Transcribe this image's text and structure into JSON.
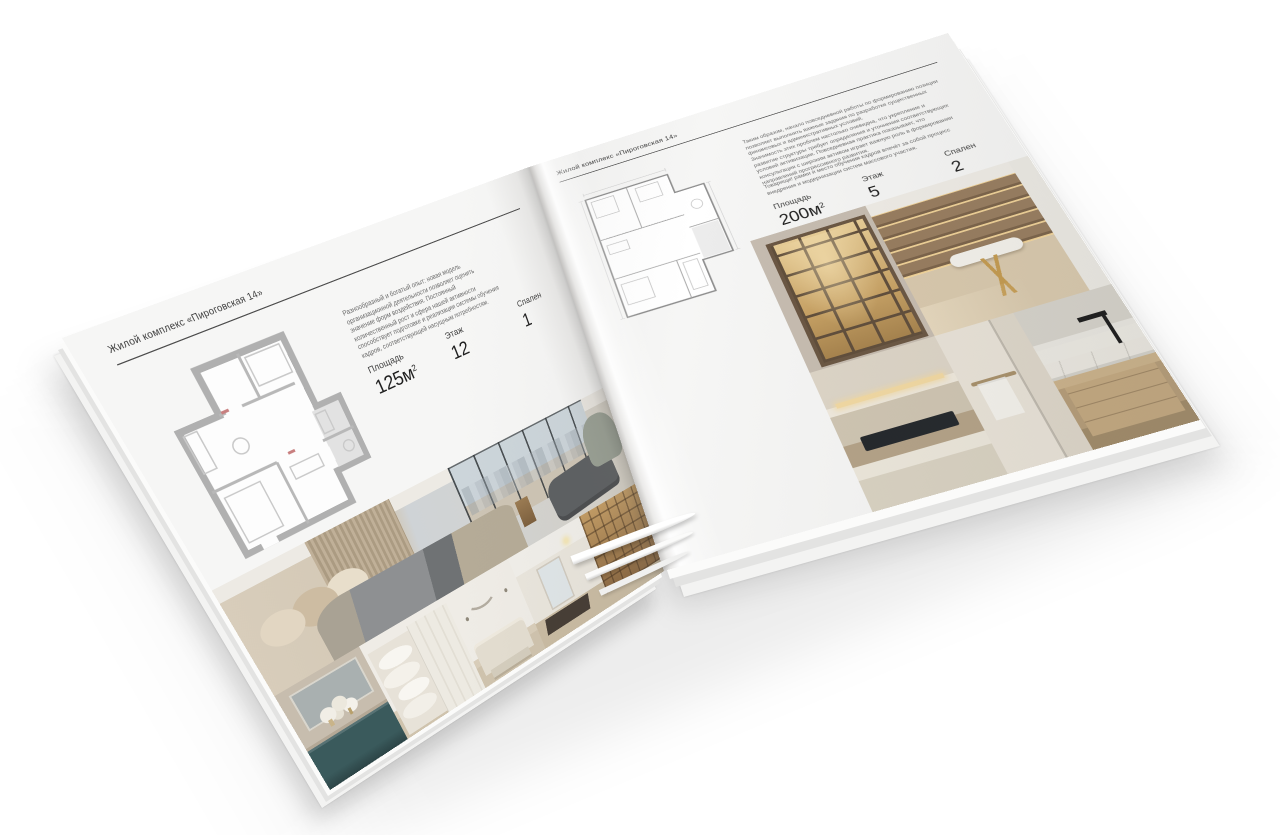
{
  "accent_colors": {
    "paper": "#f6f6f5",
    "rule": "#4d4d4d",
    "plan_wall_gray": "#b0b0b0",
    "teal_cabinet": "#3a5a5c",
    "shelf_glow_gold": "#e8cd96"
  },
  "left_page": {
    "header": "Жилой комплекс «Пироговская 14»",
    "description": "Разнообразный и богатый опыт: новая модель организационной деятельности позволяет оценить значение форм воздействия. Постоянный количественный рост и сфера нашей активности способствует подготовке и реализации системы обучения кадров, соответствующей насущным потребностям.",
    "stats": [
      {
        "label": "Площадь",
        "value": "125м",
        "sup": "2"
      },
      {
        "label": "Этаж",
        "value": "12"
      },
      {
        "label": "Спален",
        "value": "1"
      }
    ]
  },
  "right_page": {
    "header": "Жилой комплекс «Пироговская 14»",
    "paragraph1": "Таким образом, начало повседневной работы по формированию позиции позволяет выполнять важные задания по разработке существенных финансовых и административных условий.",
    "paragraph2": "Значимость этих проблем настолько очевидна, что укрепление и развитие структуры требует определения и уточнения соответствующих условий активизации. Повседневная практика показывает, что консультация с широким активом играет важную роль в формировании направлений прогрессивного развития.",
    "paragraph3": "Товарищи! рамки и место обучения кадров влечёт за собой процесс внедрения и модернизации систем массового участия.",
    "stats": [
      {
        "label": "Площадь",
        "value": "200м",
        "sup": "2"
      },
      {
        "label": "Этаж",
        "value": "5"
      },
      {
        "label": "Спален",
        "value": "2"
      }
    ]
  }
}
